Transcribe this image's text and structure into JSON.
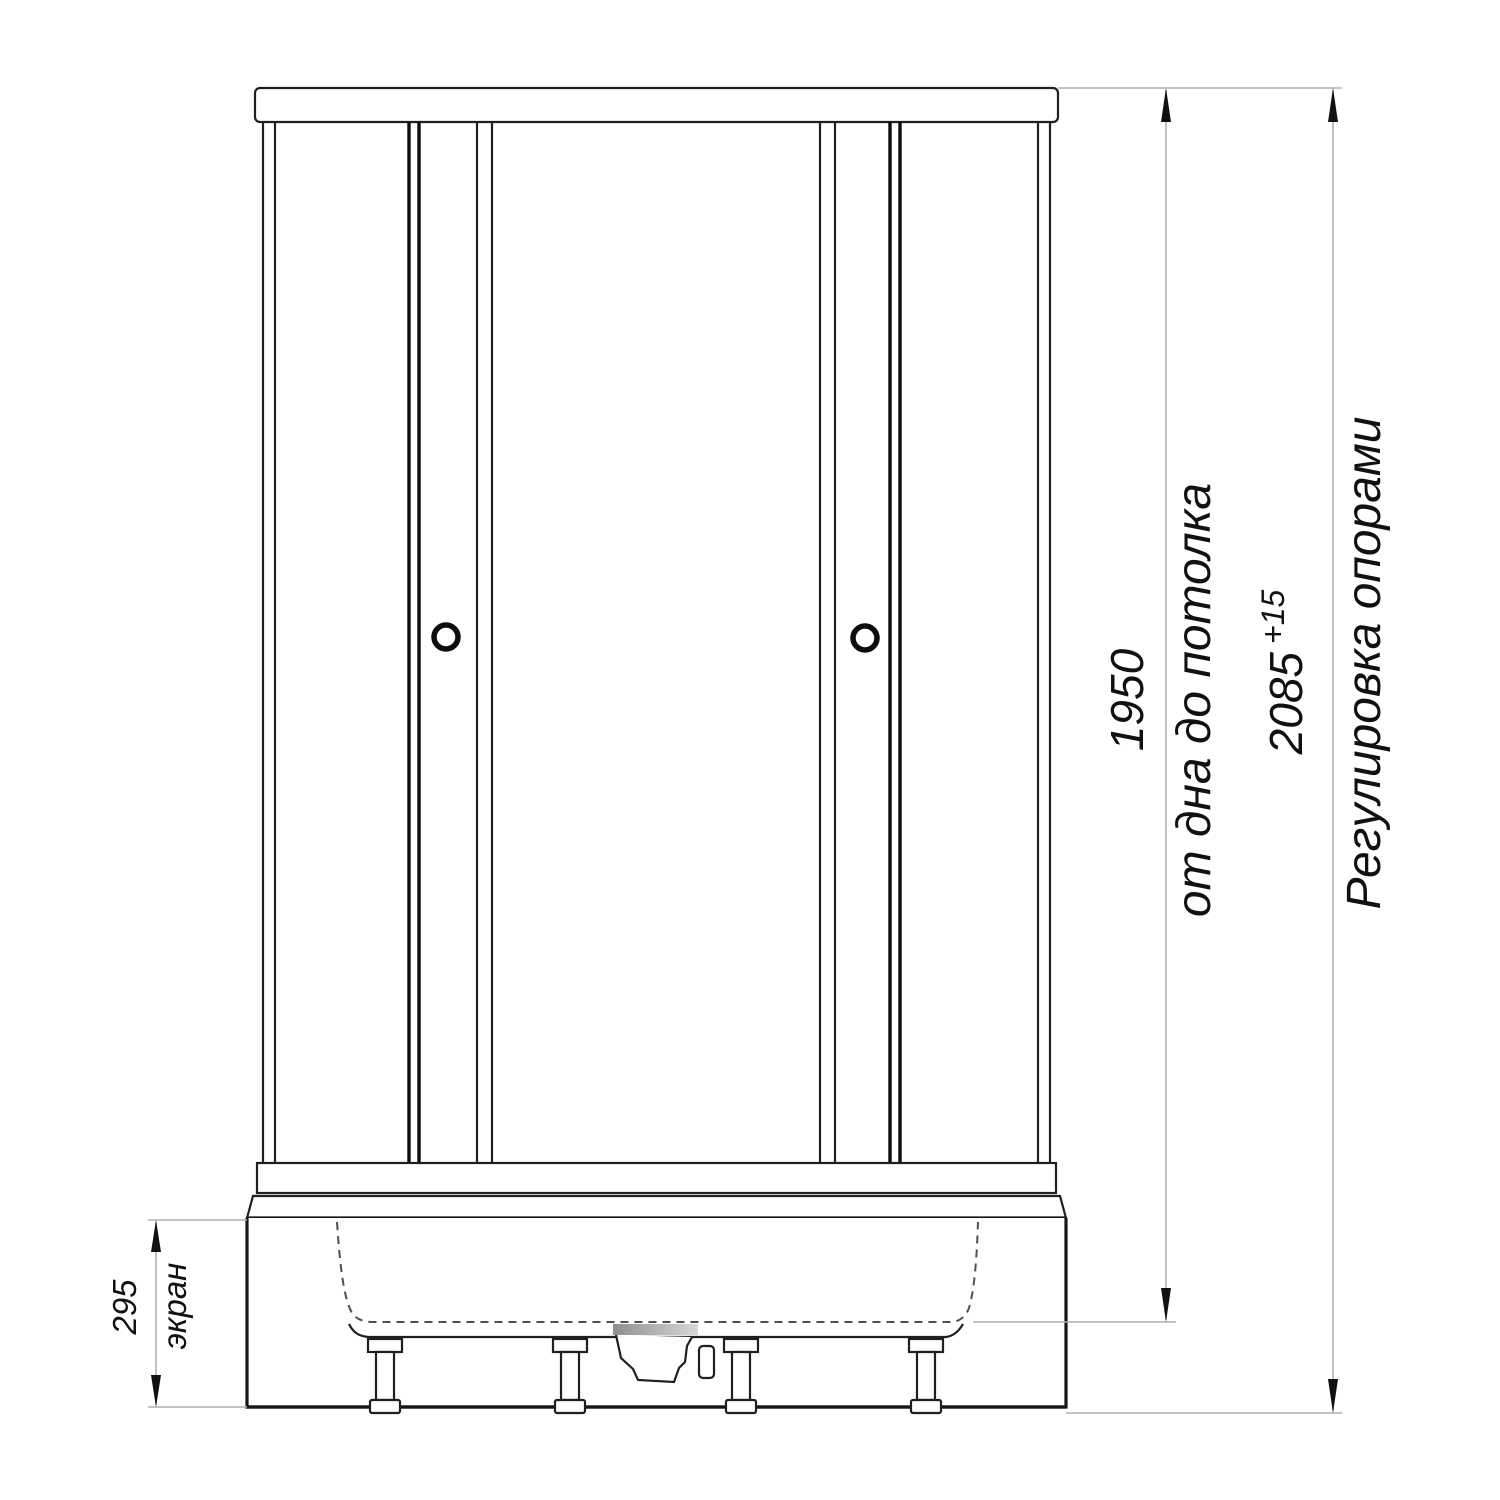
{
  "drawing": {
    "type": "shower-cabin-front-elevation",
    "line_color": "#1f1f1f",
    "dimension_line_color": "#b0b0b0",
    "dimensions": {
      "inner_height": {
        "value": "1950",
        "label": "от дна до потолка"
      },
      "total_height": {
        "value": "2085",
        "tolerance": "+15",
        "label": "Регулировка опорами"
      },
      "apron_height": {
        "value": "295",
        "label": "экран"
      }
    }
  }
}
